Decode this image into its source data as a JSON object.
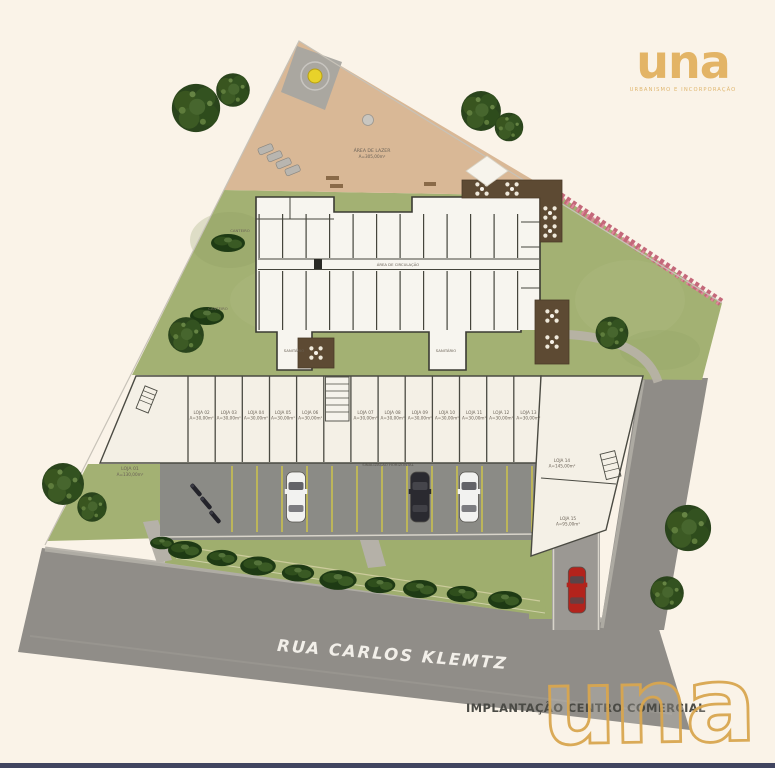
{
  "brand": {
    "logo_text": "una",
    "tagline": "URBANISMO E INCORPORAÇÃO"
  },
  "labels": {
    "street": "RUA CARLOS KLEMTZ",
    "caption": "IMPLANTAÇÃO CENTRO COMERCIAL",
    "leisure_name": "ÁREA DE LAZER",
    "leisure_area": "A=305,00m²",
    "circulation": "ÁREA DE CIRCULAÇÃO",
    "canteiro_1": "CANTEIRO",
    "canteiro_2": "CANTEIRO",
    "sanitario_1": "SANITÁRIO",
    "sanitario_2": "SANITÁRIO",
    "parking": "SINALIZAÇÃO HORIZONTAL"
  },
  "shops": {
    "loja01": {
      "name": "LOJA 01",
      "area": "A=130,00m²"
    },
    "row": [
      {
        "name": "LOJA 02",
        "area": "A=30,00m²"
      },
      {
        "name": "LOJA 03",
        "area": "A=30,00m²"
      },
      {
        "name": "LOJA 04",
        "area": "A=30,00m²"
      },
      {
        "name": "LOJA 05",
        "area": "A=30,00m²"
      },
      {
        "name": "LOJA 06",
        "area": "A=30,00m²"
      },
      {
        "name": "LOJA 07",
        "area": "A=30,00m²"
      },
      {
        "name": "LOJA 08",
        "area": "A=30,00m²"
      },
      {
        "name": "LOJA 09",
        "area": "A=30,00m²"
      },
      {
        "name": "LOJA 10",
        "area": "A=30,00m²"
      },
      {
        "name": "LOJA 11",
        "area": "A=30,00m²"
      },
      {
        "name": "LOJA 12",
        "area": "A=30,00m²"
      },
      {
        "name": "LOJA 13",
        "area": "A=30,00m²"
      }
    ],
    "loja14": {
      "name": "LOJA 14",
      "area": "A=145,00m²"
    },
    "loja15": {
      "name": "LOJA 15",
      "area": "A=95,00m²"
    }
  },
  "colors": {
    "background_ivory": "#FAF3E8",
    "brand_gold": "#E3B466",
    "watermark_gold": "#D9A750",
    "lawn_green": "#A3B173",
    "tree_green": "#2A441C",
    "terrace_tan": "#D9B896",
    "road_gray": "#908D88",
    "parking_gray": "#8B8B86",
    "deck_brown": "#5D4A33",
    "hedge_pink": "#C4687A",
    "car_red": "#B3231C",
    "street_text": "#F2EFE9",
    "caption_text": "#4A4A45",
    "bottom_bar": "#2B3150"
  }
}
